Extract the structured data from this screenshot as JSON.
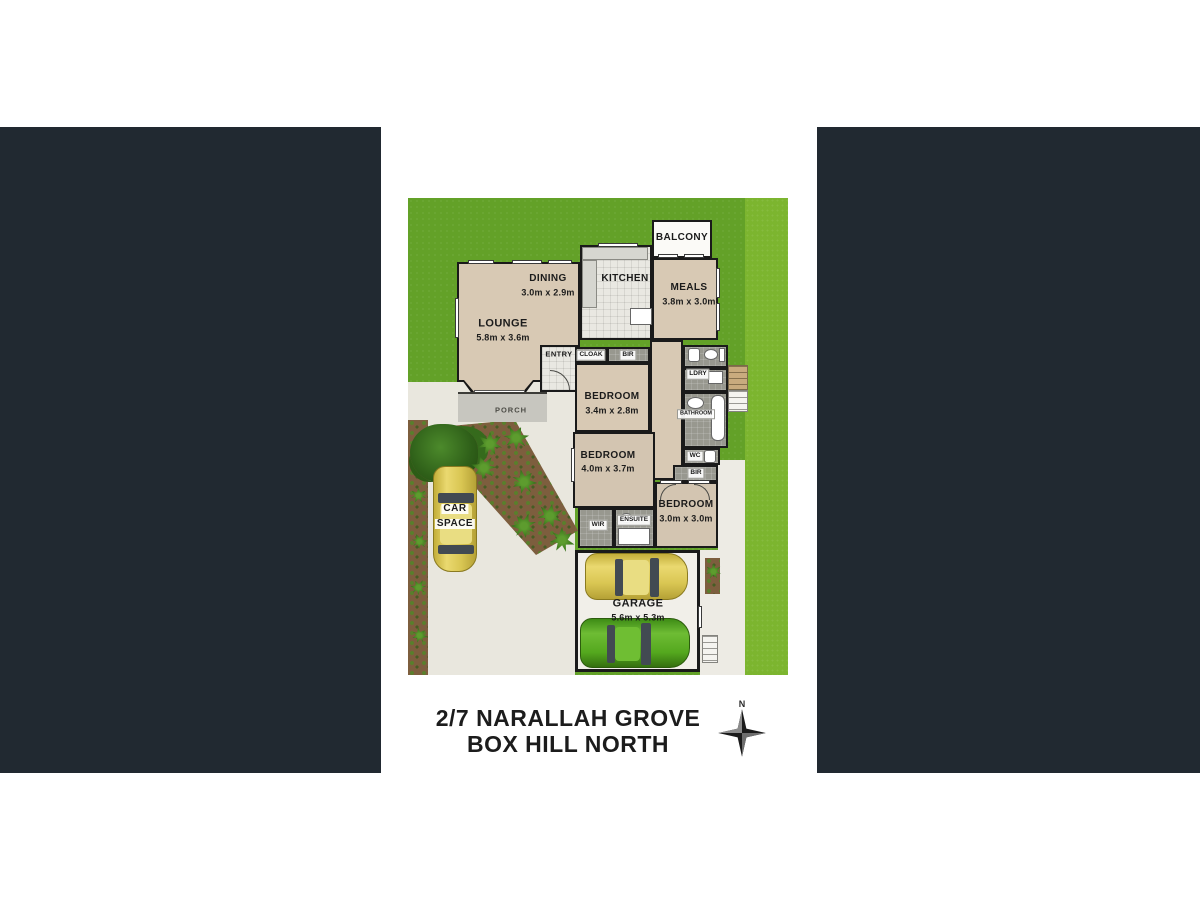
{
  "window": {
    "background_color": "#ffffff",
    "mask_panel_color": "#212931"
  },
  "floorplan": {
    "address": {
      "line1": "2/7 NARALLAH GROVE",
      "line2": "BOX HILL NORTH"
    },
    "compass": {
      "north_label": "N"
    },
    "colors": {
      "grass": "#63a128",
      "grass_strip": "#7cb52f",
      "floor": "#d8c9b4",
      "wall": "#1a1a1a",
      "driveway": "#e9e7de",
      "garden_soil": "#7d5e3e",
      "car_yellow": "#d9c653",
      "car_green": "#54a81e"
    },
    "rooms": {
      "balcony": {
        "name": "BALCONY"
      },
      "dining": {
        "name": "DINING",
        "dims": "3.0m x 2.9m"
      },
      "kitchen": {
        "name": "KITCHEN"
      },
      "meals": {
        "name": "MEALS",
        "dims": "3.8m x 3.0m"
      },
      "lounge": {
        "name": "LOUNGE",
        "dims": "5.8m x 3.6m"
      },
      "entry": {
        "name": "ENTRY"
      },
      "cloak": {
        "name": "CLOAK"
      },
      "bir_hall": {
        "name": "BIR"
      },
      "bedroom1": {
        "name": "BEDROOM",
        "dims": "3.4m x 2.8m"
      },
      "ldry": {
        "name": "LDRY"
      },
      "bathroom": {
        "name": "BATHROOM"
      },
      "wc": {
        "name": "WC"
      },
      "bir_rear": {
        "name": "BIR"
      },
      "bedroom2": {
        "name": "BEDROOM",
        "dims": "4.0m x 3.7m"
      },
      "wir": {
        "name": "WIR"
      },
      "ensuite": {
        "name": "ENSUITE"
      },
      "bedroom3": {
        "name": "BEDROOM",
        "dims": "3.0m x 3.0m"
      },
      "garage": {
        "name": "GARAGE",
        "dims": "5.6m x 5.3m"
      },
      "porch": {
        "name": "PORCH"
      },
      "car_space": {
        "line1": "CAR",
        "line2": "SPACE"
      }
    }
  }
}
